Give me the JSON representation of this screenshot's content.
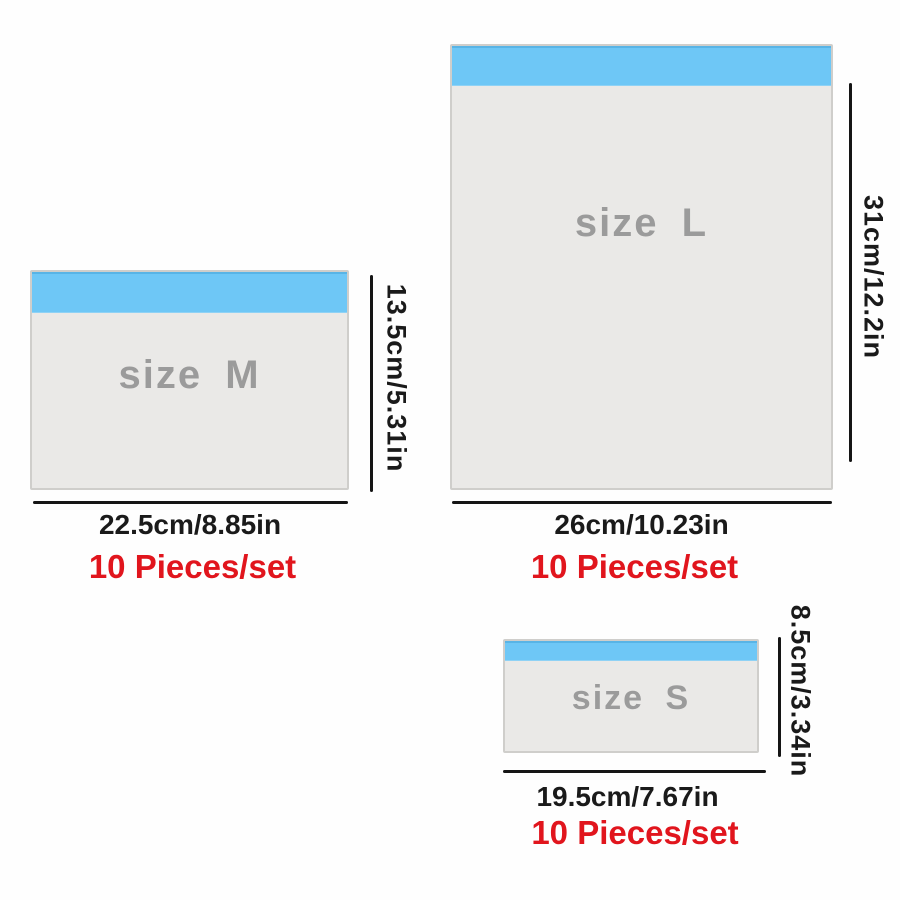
{
  "image_type": "product-size-diagram",
  "background_color": "#fefefe",
  "colors": {
    "seal_strip_blue": "#6ec7f6",
    "seal_strip_edge_blue": "#58b4e6",
    "bag_body_gray": "#eae9e7",
    "bag_border_gray": "#cfcecb",
    "size_text_gray": "#9b9b9b",
    "dimension_black": "#1a1a1a",
    "pieces_red": "#e1151d"
  },
  "bags": [
    {
      "id": "M",
      "size_label": "size M",
      "width_label": "22.5cm/8.85in",
      "height_label": "13.5cm/5.31in",
      "pieces_label": "10 Pieces/set"
    },
    {
      "id": "L",
      "size_label": "size L",
      "width_label": "26cm/10.23in",
      "height_label": "31cm/12.2in",
      "pieces_label": "10 Pieces/set"
    },
    {
      "id": "S",
      "size_label": "size S",
      "width_label": "19.5cm/7.67in",
      "height_label": "8.5cm/3.34in",
      "pieces_label": "10 Pieces/set"
    }
  ]
}
